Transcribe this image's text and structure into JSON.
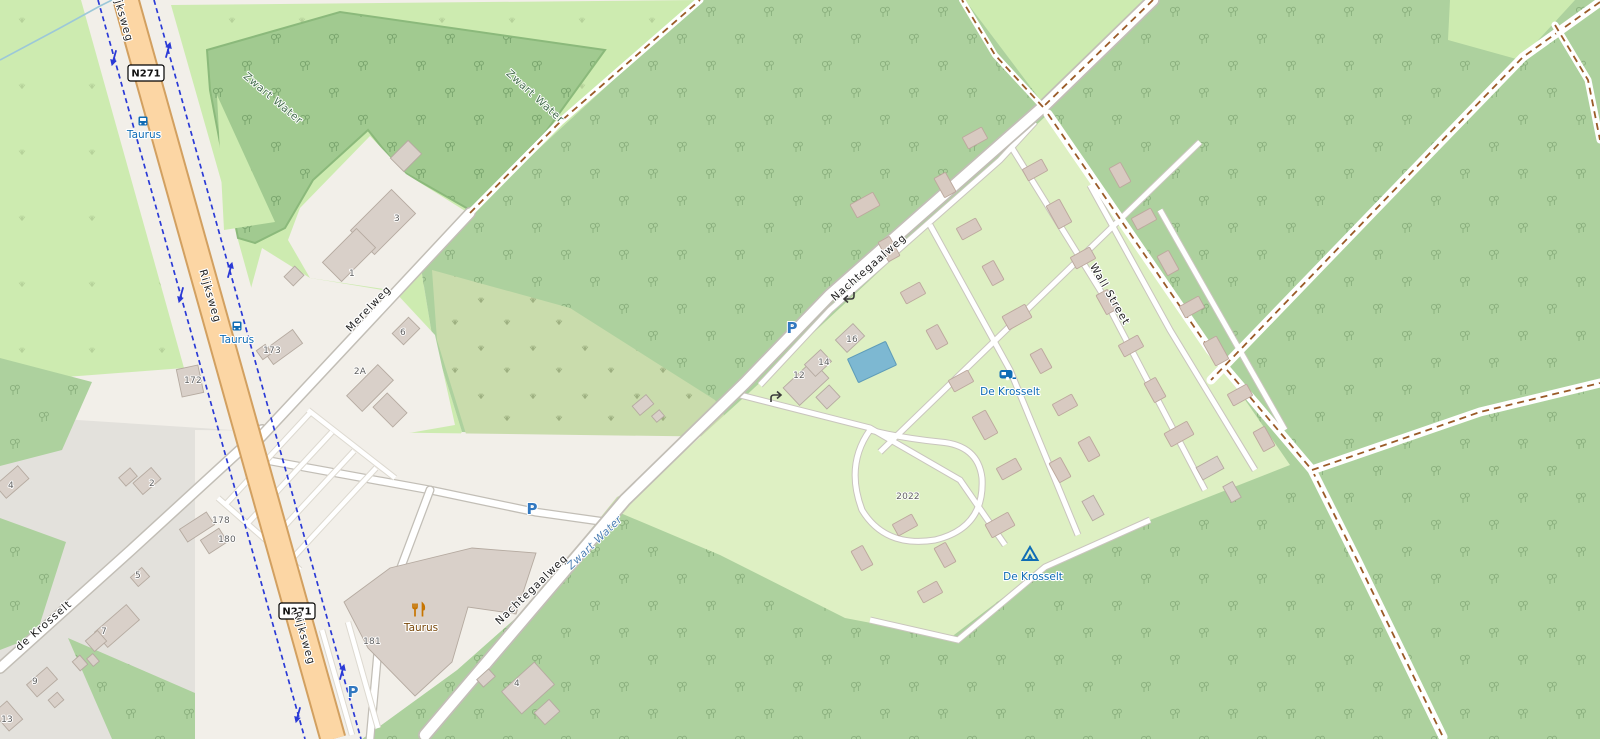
{
  "map": {
    "description": "Web map view of a rural Dutch area: provincial road N271 (Rijksweg), Zwart Water woods, De Krosselt caravan and camp site, Taurus restaurant",
    "zoom_hint": "street level"
  },
  "labels": [
    {
      "text": "N271",
      "kind": "road-ref"
    },
    {
      "text": "N271",
      "kind": "road-ref"
    },
    {
      "text": "Rijksweg",
      "kind": "street"
    },
    {
      "text": "Rijksweg",
      "kind": "street"
    },
    {
      "text": "Rijksweg",
      "kind": "street"
    },
    {
      "text": "de Krosselt",
      "kind": "street"
    },
    {
      "text": "Merelweg",
      "kind": "street"
    },
    {
      "text": "Nachtegaalweg",
      "kind": "street"
    },
    {
      "text": "Nachtegaalweg",
      "kind": "street"
    },
    {
      "text": "Wall Street",
      "kind": "street"
    },
    {
      "text": "Zwart Water",
      "kind": "area"
    },
    {
      "text": "Zwart Water",
      "kind": "area"
    },
    {
      "text": "Zwart Water",
      "kind": "waterway"
    },
    {
      "text": "Taurus",
      "kind": "bus-stop"
    },
    {
      "text": "Taurus",
      "kind": "bus-stop"
    },
    {
      "text": "De Krosselt",
      "kind": "caravan-site"
    },
    {
      "text": "De Krosselt",
      "kind": "camp-site"
    },
    {
      "text": "Taurus",
      "kind": "restaurant"
    },
    {
      "text": "3",
      "kind": "house-number"
    },
    {
      "text": "1",
      "kind": "house-number"
    },
    {
      "text": "6",
      "kind": "house-number"
    },
    {
      "text": "2A",
      "kind": "house-number"
    },
    {
      "text": "173",
      "kind": "house-number"
    },
    {
      "text": "172",
      "kind": "house-number"
    },
    {
      "text": "178",
      "kind": "house-number"
    },
    {
      "text": "180",
      "kind": "house-number"
    },
    {
      "text": "2",
      "kind": "house-number"
    },
    {
      "text": "4",
      "kind": "house-number"
    },
    {
      "text": "5",
      "kind": "house-number"
    },
    {
      "text": "7",
      "kind": "house-number"
    },
    {
      "text": "9",
      "kind": "house-number"
    },
    {
      "text": "13",
      "kind": "house-number"
    },
    {
      "text": "181",
      "kind": "house-number"
    },
    {
      "text": "4",
      "kind": "house-number"
    },
    {
      "text": "12",
      "kind": "house-number"
    },
    {
      "text": "14",
      "kind": "house-number"
    },
    {
      "text": "16",
      "kind": "house-number"
    },
    {
      "text": "2022",
      "kind": "house-number"
    }
  ],
  "icons": {
    "parking_glyph": "P",
    "bus_stop": "bus-icon",
    "caravan_site": "caravan-icon",
    "camp_site": "tent-icon",
    "restaurant": "fork-knife-icon",
    "oneway": "turn-arrow-icon",
    "cycleway_arrow": "blue-arrow-icon"
  },
  "colors": {
    "base_land": "#F2EFE9",
    "forest": "#ADD19E",
    "grass": "#CDEBB0",
    "scrub": "#C9DCAC",
    "camp_site": "#DEF0C3",
    "residential": "#E3E1DC",
    "primary_road": "#FCD6A4",
    "minor_road": "#FFFFFF",
    "track_dash": "#9A5B28",
    "cycleway": "#2B3AD6",
    "water": "#7DB8D2",
    "building": "#D9D0C9",
    "poi_blue": "#0F6CB5",
    "poi_brown": "#79480A"
  }
}
